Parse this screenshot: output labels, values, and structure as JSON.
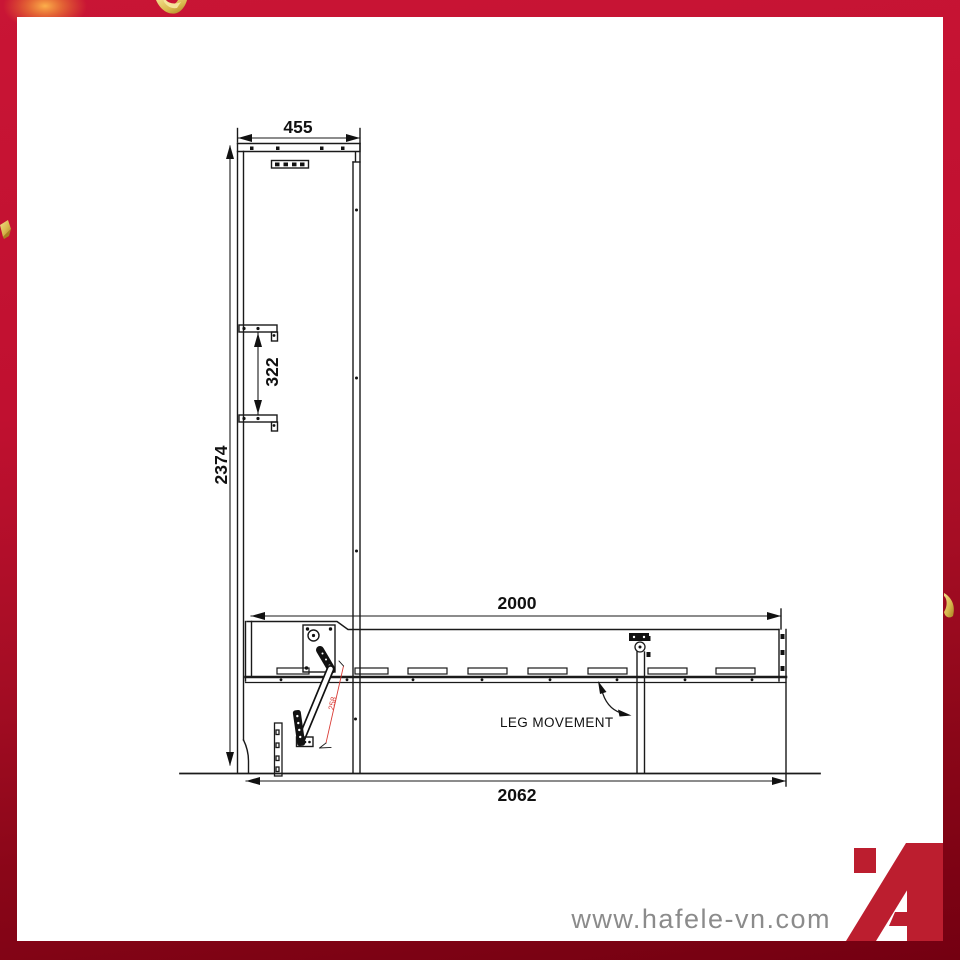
{
  "brand": {
    "website": "www.hafele-vn.com",
    "logo_letter": "A",
    "logo_color": "#bc1e2f"
  },
  "frame": {
    "border_color_top": "#c91535",
    "border_color_bottom": "#740011",
    "confetti_color": "#d9b94e"
  },
  "drawing": {
    "type": "technical-dimension-drawing",
    "subject": "wall-bed cabinet side elevation with fold-down bed frame and pivoting leg",
    "line_color": "#1a1a1a",
    "dimensions": {
      "cabinet_width": "455",
      "bracket_spacing": "322",
      "cabinet_height": "2374",
      "bed_length": "2000",
      "overall_depth": "2062",
      "lever_stroke": "258"
    },
    "labels": {
      "leg_movement": "LEG MOVEMENT"
    }
  }
}
